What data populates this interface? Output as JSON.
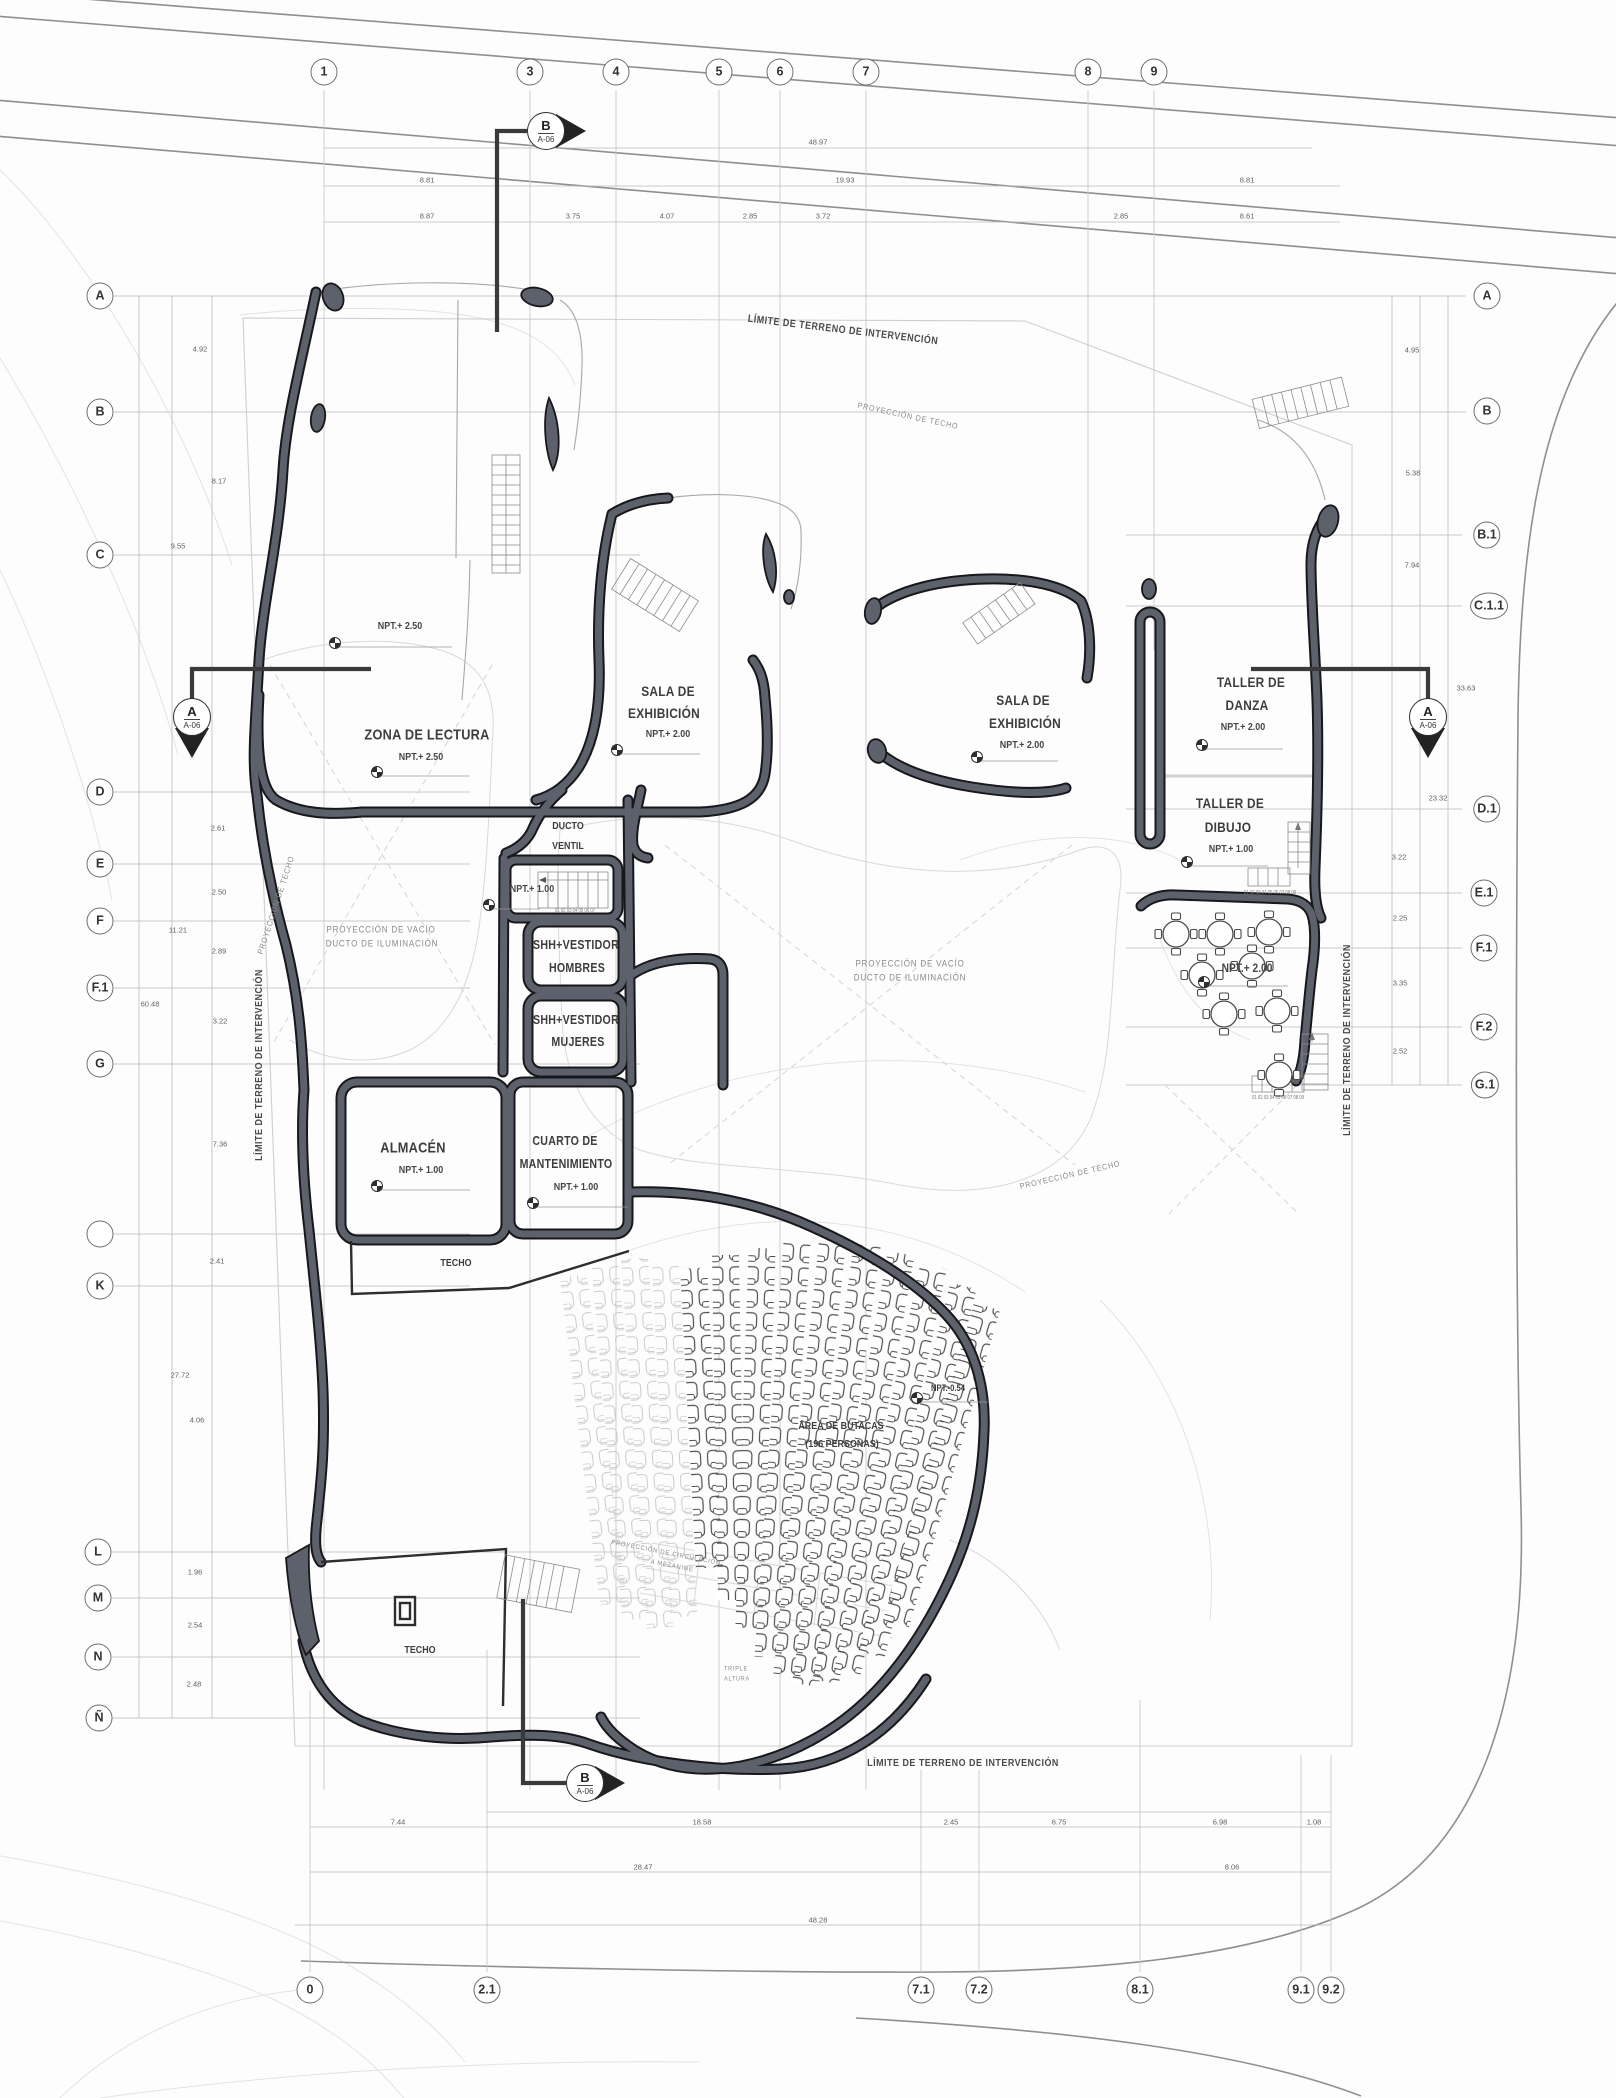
{
  "colors": {
    "wall_fill": "#5c616b",
    "wall_edge": "#17171c",
    "grid": "#c9c9c9",
    "dim_text": "#5f5f5f",
    "road": "#8f8f8f",
    "accent_text": "#3d3d3d"
  },
  "grid": {
    "top": [
      "1",
      "3",
      "4",
      "5",
      "6",
      "7",
      "8",
      "9"
    ],
    "left": [
      "A",
      "B",
      "C",
      "D",
      "E",
      "F",
      "F.1",
      "G",
      "",
      "K",
      "L",
      "M",
      "N",
      "Ñ"
    ],
    "right": [
      "A",
      "B",
      "B.1",
      "C.1.1",
      "D.1",
      "E.1",
      "F.1",
      "F.2",
      "G.1"
    ],
    "bottom": [
      "0",
      "2.1",
      "7.1",
      "7.2",
      "8.1",
      "9.1",
      "9.2"
    ]
  },
  "sections": {
    "top": {
      "letter": "B",
      "sheet": "A-06"
    },
    "left": {
      "letter": "A",
      "sheet": "A-06"
    },
    "right": {
      "letter": "A",
      "sheet": "A-06"
    },
    "bottom": {
      "letter": "B",
      "sheet": "A-06"
    }
  },
  "site": {
    "limit": "LÍMITE DE TERRENO DE INTERVENCIÓN",
    "proy_techo": "PROYECCIÓN DE TECHO",
    "vacio1": "PROYECCIÓN DE VACÍO",
    "vacio2": "DUCTO DE ILUMINACIÓN",
    "mez1": "PROYECCIÓN DE CIRCULACIÓN",
    "mez2": "A MEZANINE",
    "triple1": "TRIPLE",
    "triple2": "ALTURA"
  },
  "rooms": {
    "upper": {
      "l": "NPT.+ 2.50"
    },
    "lect": {
      "n": "ZONA DE LECTURA",
      "l": "NPT.+ 2.50"
    },
    "sala1": {
      "n1": "SALA DE",
      "n2": "EXHIBICIÓN",
      "l": "NPT.+ 2.00"
    },
    "sala2": {
      "n1": "SALA DE",
      "n2": "EXHIBICIÓN",
      "l": "NPT.+ 2.00"
    },
    "danza": {
      "n1": "TALLER DE",
      "n2": "DANZA",
      "l": "NPT.+ 2.00"
    },
    "dibujo": {
      "n1": "TALLER DE",
      "n2": "DIBUJO",
      "l": "NPT.+ 1.00"
    },
    "terraza": {
      "l": "NPT.+ 2.00"
    },
    "ducto": {
      "n1": "DUCTO",
      "n2": "VENTIL"
    },
    "vest": {
      "l": "NPT.+ 1.00"
    },
    "shhh": {
      "n1": "SHH+VESTIDOR",
      "n2": "HOMBRES"
    },
    "shhm": {
      "n1": "SHH+VESTIDOR",
      "n2": "MUJERES"
    },
    "alma": {
      "n": "ALMACÉN",
      "l": "NPT.+ 1.00"
    },
    "mant": {
      "n1": "CUARTO DE",
      "n2": "MANTENIMIENTO",
      "l": "NPT.+ 1.00"
    },
    "techo1": {
      "n": "TECHO"
    },
    "techo2": {
      "n": "TECHO"
    },
    "butacas": {
      "n1": "ÁREA DE BUTACAS",
      "n2": "(196 PERSONAS)",
      "l": "NPT.-0.54"
    }
  },
  "dims": {
    "t1": [
      "48.97"
    ],
    "t2": [
      "8.81",
      "19.93",
      "8.81"
    ],
    "t3": [
      "8.87",
      "3.75",
      "4.07",
      "2.85",
      "3.72",
      "2.85",
      "8.61"
    ],
    "left": [
      "4.92",
      "8.17",
      "9.55",
      "2.61",
      "2.50",
      "11.21",
      "2.89",
      "60.48",
      "3.22",
      "7.36",
      "2.41",
      "27.72",
      "4.06",
      "1.96",
      "2.54",
      "2.48"
    ],
    "right": [
      "4.95",
      "5.38",
      "7.94",
      "33.63",
      "23.32",
      "3.22",
      "2.25",
      "3.35",
      "2.52"
    ],
    "b1": [
      "7.44",
      "18.58",
      "2.45",
      "6.75",
      "6.98",
      "1.08"
    ],
    "b2": [
      "28.47",
      "8.06"
    ],
    "b3": [
      "48.28"
    ]
  },
  "misc": {
    "steps": "01 02 03 04 05 06 07",
    "steps2": "01 02 03 04 05 06 07 08 09"
  }
}
